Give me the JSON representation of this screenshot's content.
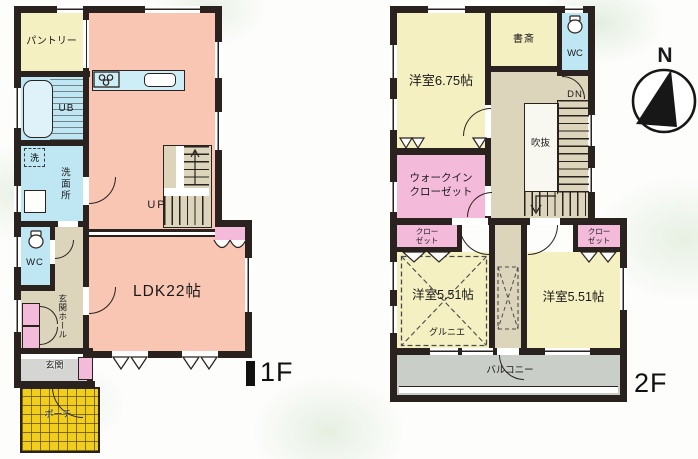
{
  "floor1": {
    "label": "1F",
    "rooms": {
      "pantry": "パントリー",
      "bath": "UB",
      "laundry": "洗",
      "washroom": "洗面所",
      "wc": "WC",
      "entrance_hall": "玄関ホール",
      "entrance": "玄関",
      "porch": "ポーチ",
      "ldk": "LDK22帖",
      "stairs": "UP"
    }
  },
  "floor2": {
    "label": "2F",
    "rooms": {
      "bedroom_a": "洋室6.75帖",
      "study": "書斎",
      "wc": "WC",
      "stairs": "DN",
      "void": "吹抜",
      "wic_line1": "ウォークイン",
      "wic_line2": "クローゼット",
      "closet_left_line1": "クロー",
      "closet_left_line2": "ゼット",
      "closet_right_line1": "クロー",
      "closet_right_line2": "ゼット",
      "bedroom_b": "洋室5.51帖",
      "bedroom_c": "洋室5.51帖",
      "grenier": "グルニエ",
      "balcony": "バルコニー"
    }
  },
  "compass": {
    "north": "N"
  },
  "colors": {
    "wall": "#29221f",
    "ldk_pink": "#f8c6b3",
    "room_yellow": "#f5f0c2",
    "water_blue": "#bfe7f3",
    "closet_pink": "#f4bada",
    "hall_beige": "#dcd5bb",
    "balcony_gray": "#c9cec8",
    "entrance_gray": "#d5d5d3",
    "porch_gold": "#f2ce1c"
  }
}
